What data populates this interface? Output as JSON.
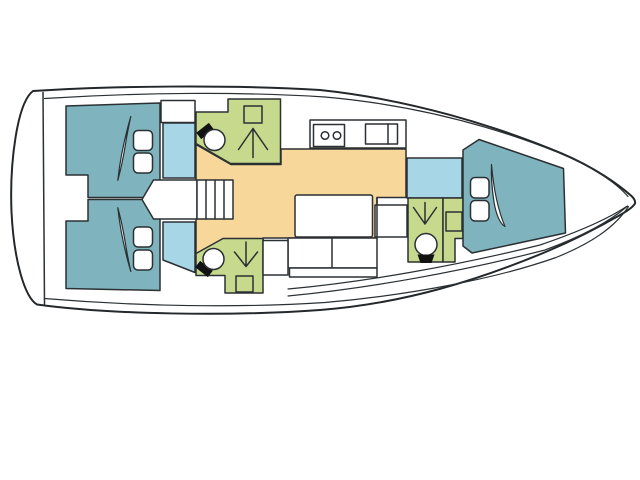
{
  "colors": {
    "background": "#ffffff",
    "outline": "#2b3033",
    "hull": "#ffffff",
    "furniture": "#ffffff",
    "berth_cabin": "#7fb4be",
    "corridor": "#a7d7e6",
    "head_bathroom": "#c6d98c",
    "salon": "#f8d79a",
    "fixture_dark": "#121212"
  },
  "diagram": {
    "type": "sailboat-interior-deck-plan",
    "orientation": "bow-right",
    "rooms": [
      {
        "id": "aft-cabin-top",
        "kind": "double-berth-cabin",
        "color_key": "berth_cabin",
        "fixtures": [
          "double-berth",
          "pillow",
          "pillow"
        ]
      },
      {
        "id": "aft-cabin-bottom",
        "kind": "double-berth-cabin",
        "color_key": "berth_cabin",
        "fixtures": [
          "double-berth",
          "pillow",
          "pillow"
        ]
      },
      {
        "id": "aft-head-top",
        "kind": "bathroom",
        "color_key": "head_bathroom",
        "fixtures": [
          "toilet",
          "shower",
          "washbasin"
        ]
      },
      {
        "id": "aft-head-bottom",
        "kind": "bathroom",
        "color_key": "head_bathroom",
        "fixtures": [
          "toilet",
          "shower",
          "washbasin"
        ]
      },
      {
        "id": "forward-head",
        "kind": "bathroom",
        "color_key": "head_bathroom",
        "fixtures": [
          "toilet",
          "shower",
          "washbasin"
        ]
      },
      {
        "id": "forward-cabin",
        "kind": "v-berth-cabin",
        "color_key": "berth_cabin",
        "fixtures": [
          "v-berth",
          "pillow",
          "pillow"
        ]
      },
      {
        "id": "salon",
        "kind": "saloon",
        "color_key": "salon",
        "fixtures": [
          "table",
          "settee",
          "nav-seat"
        ]
      },
      {
        "id": "galley",
        "kind": "galley",
        "color_key": "furniture",
        "fixtures": [
          "stove-two-burners",
          "double-sink"
        ]
      },
      {
        "id": "companionway",
        "kind": "stairs",
        "color_key": "furniture",
        "fixtures": [
          "steps"
        ]
      },
      {
        "id": "corridor",
        "kind": "passageway",
        "color_key": "corridor",
        "fixtures": []
      }
    ]
  }
}
